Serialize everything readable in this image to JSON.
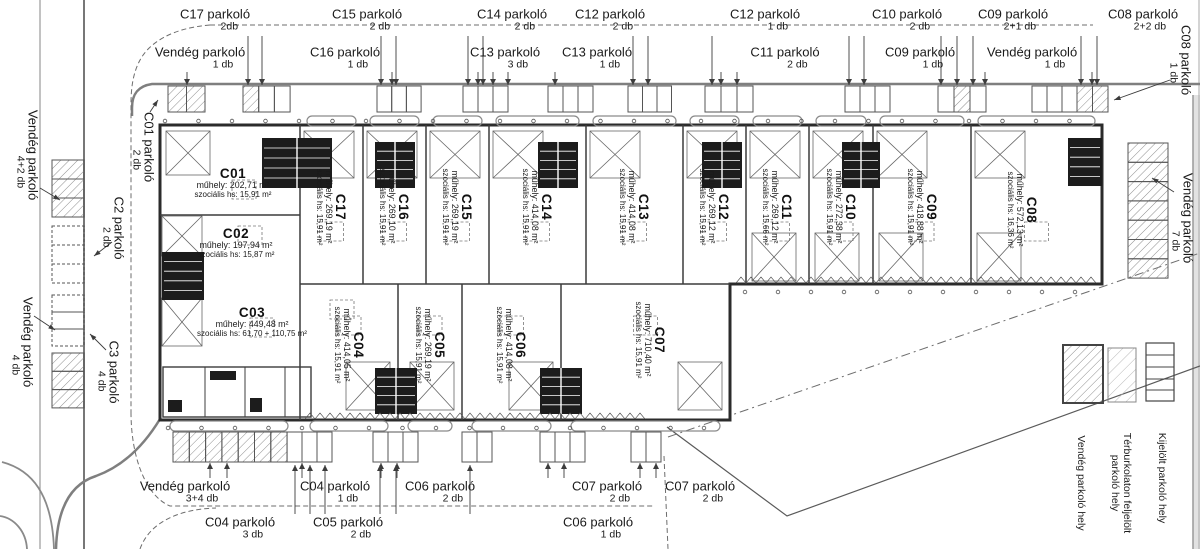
{
  "parking_labels": {
    "top_row1": [
      {
        "name": "C17 parkoló",
        "count": "2db"
      },
      {
        "name": "C15 parkoló",
        "count": "2 db"
      },
      {
        "name": "C14 parkoló",
        "count": "2 db"
      },
      {
        "name": "C12 parkoló",
        "count": "2 db"
      },
      {
        "name": "C12 parkoló",
        "count": "1 db"
      },
      {
        "name": "C10 parkoló",
        "count": "2 db"
      },
      {
        "name": "C09 parkoló",
        "count": "2+1 db"
      },
      {
        "name": "C08 parkoló",
        "count": "2+2 db"
      }
    ],
    "top_row2": [
      {
        "name": "Vendég parkoló",
        "count": "1 db"
      },
      {
        "name": "C16 parkoló",
        "count": "1 db"
      },
      {
        "name": "C13 parkoló",
        "count": "3 db"
      },
      {
        "name": "C13 parkoló",
        "count": "1 db"
      },
      {
        "name": "C11 parkoló",
        "count": "2 db"
      },
      {
        "name": "C09 parkoló",
        "count": "1 db"
      },
      {
        "name": "Vendég parkoló",
        "count": "1 db"
      }
    ],
    "right_top": {
      "name": "C08 parkoló",
      "count": "1 db"
    },
    "right_side": {
      "name": "Vendég parkoló",
      "count": "7 db"
    },
    "left": [
      {
        "name": "Vendég parkoló",
        "count": "4+2 db"
      },
      {
        "name": "C01 parkoló",
        "count": "2 db"
      },
      {
        "name": "C2 parkoló",
        "count": "2 db"
      },
      {
        "name": "C3 parkoló",
        "count": "4 db"
      },
      {
        "name": "Vendég parkoló",
        "count": "4 db"
      }
    ],
    "bottom_row1": [
      {
        "name": "Vendég parkoló",
        "count": "3+4 db"
      },
      {
        "name": "C04 parkoló",
        "count": "1 db"
      },
      {
        "name": "C06 parkoló",
        "count": "2 db"
      },
      {
        "name": "C07 parkoló",
        "count": "2 db"
      },
      {
        "name": "C07 parkoló",
        "count": "2 db"
      }
    ],
    "bottom_row2": [
      {
        "name": "C04 parkoló",
        "count": "3 db"
      },
      {
        "name": "C05 parkoló",
        "count": "2 db"
      },
      {
        "name": "C06 parkoló",
        "count": "1 db"
      }
    ]
  },
  "units": [
    {
      "id": "C01",
      "muhely": "műhely: 202,71 m²",
      "szocialis": "szociális hs: 15,91 m²"
    },
    {
      "id": "C02",
      "muhely": "műhely: 197,94 m²",
      "szocialis": "szociális hs: 15,87 m²"
    },
    {
      "id": "C03",
      "muhely": "műhely: 449,48 m²",
      "szocialis": "szociális hs: 61,70 + 110,75 m²"
    },
    {
      "id": "C17",
      "muhely": "műhely: 269,19 m²",
      "szocialis": "szociális hs: 15,91 m²"
    },
    {
      "id": "C16",
      "muhely": "műhely: 269,10 m²",
      "szocialis": "szociális hs: 15,91 m²"
    },
    {
      "id": "C15",
      "muhely": "műhely: 269,19 m²",
      "szocialis": "szociális hs: 15,91 m²"
    },
    {
      "id": "C14",
      "muhely": "műhely: 414,08 m²",
      "szocialis": "szociális hs: 15,91 m²"
    },
    {
      "id": "C13",
      "muhely": "műhely: 414,08 m²",
      "szocialis": "szociális hs: 15,91 m²"
    },
    {
      "id": "C12",
      "muhely": "műhely: 269,12 m²",
      "szocialis": "szociális hs: 15,91 m²"
    },
    {
      "id": "C11",
      "muhely": "műhely: 269,12 m²",
      "szocialis": "szociális hs: 15,66 m²"
    },
    {
      "id": "C10",
      "muhely": "műhely: 272,38 m²",
      "szocialis": "szociális hs: 15,91 m²"
    },
    {
      "id": "C09",
      "muhely": "műhely: 418,88 m²",
      "szocialis": "szociális hs: 15,91 m²"
    },
    {
      "id": "C08",
      "muhely": "műhely: 572,13 m²",
      "szocialis": "szociális hs: 16,36 m²"
    },
    {
      "id": "C04",
      "muhely": "műhely: 414,05 m²",
      "szocialis": "szociális hs: 15,91 m²"
    },
    {
      "id": "C05",
      "muhely": "műhely: 269,19 m²",
      "szocialis": "szociális hs: 15,91 m²"
    },
    {
      "id": "C06",
      "muhely": "műhely: 414,08 m²",
      "szocialis": "szociális hs: 15,91 m²"
    },
    {
      "id": "C07",
      "muhely": "műhely: 710,40 m²",
      "szocialis": "szociális hs: 15,91 m²"
    }
  ],
  "legend": [
    {
      "label": "Vendég parkoló hely"
    },
    {
      "label": "Térburkolaton feljelölt parkoló hely"
    },
    {
      "label": "Kijelölt parkoló hely"
    }
  ]
}
